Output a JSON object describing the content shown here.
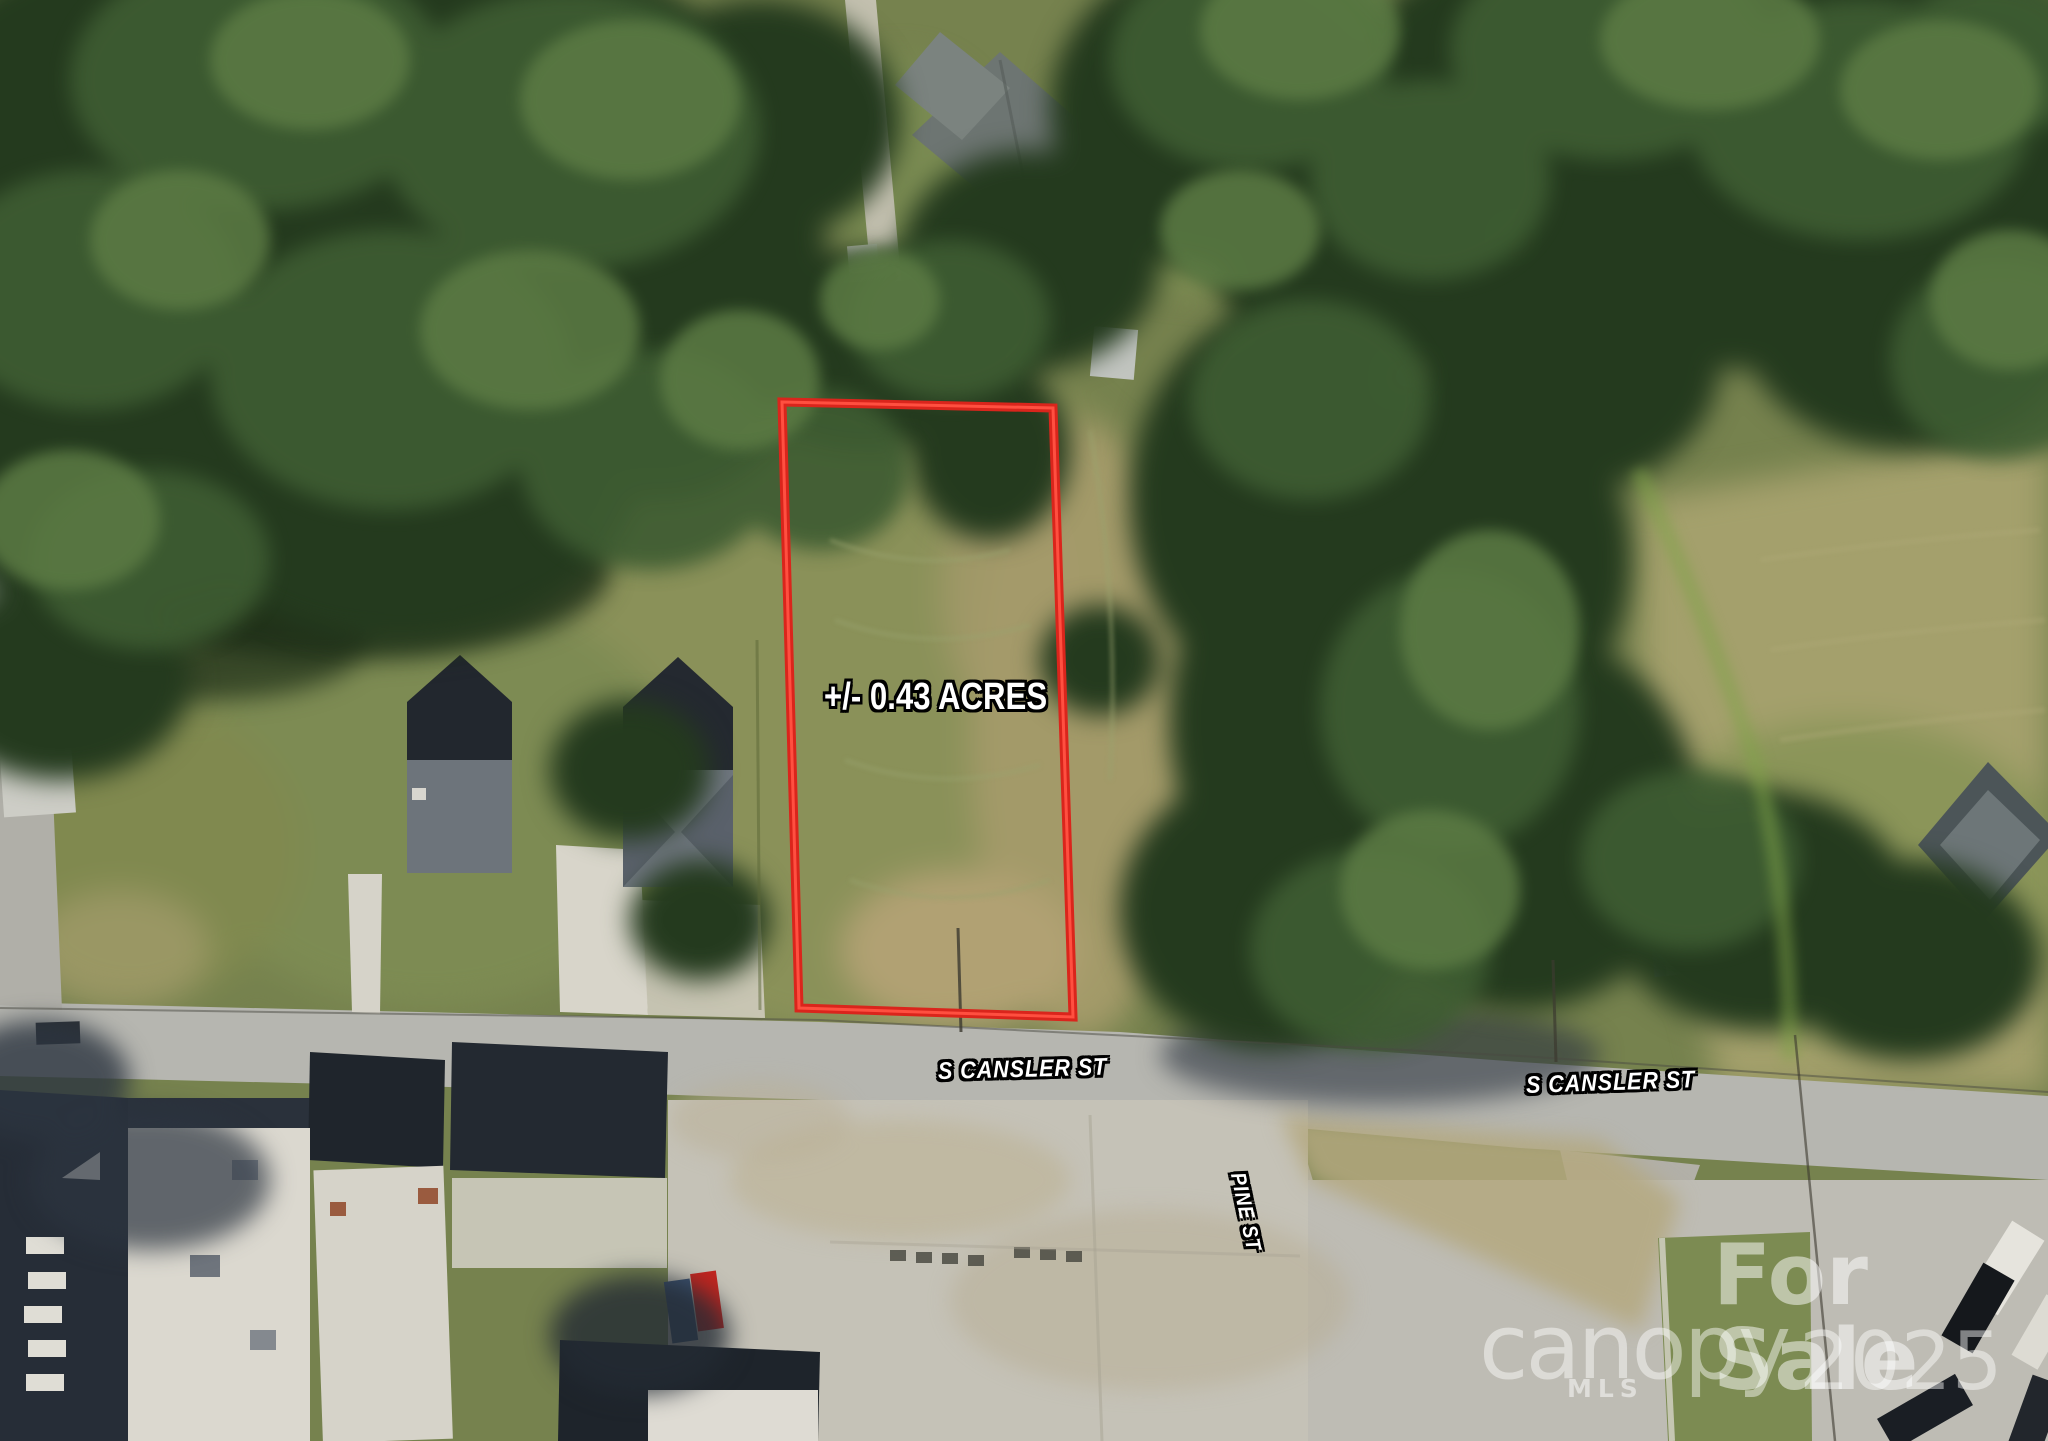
{
  "meta": {
    "type": "aerial-property-listing-photo"
  },
  "annotations": {
    "acreage": "+/- 0.43 ACRES",
    "streets": {
      "cansler_west": "S CANSLER ST",
      "cansler_east": "S CANSLER ST",
      "pine": "PINE ST"
    }
  },
  "watermark": {
    "for_sale": "For Sale",
    "brand": "canopy",
    "brand_sub": "MLS",
    "year": "2025"
  },
  "colors": {
    "lot_outline": "#da251c",
    "lot_outline_highlight": "#ff4f40",
    "label_text": "#ffffff",
    "label_outline": "#000000",
    "watermark_text": "#ffffff"
  }
}
